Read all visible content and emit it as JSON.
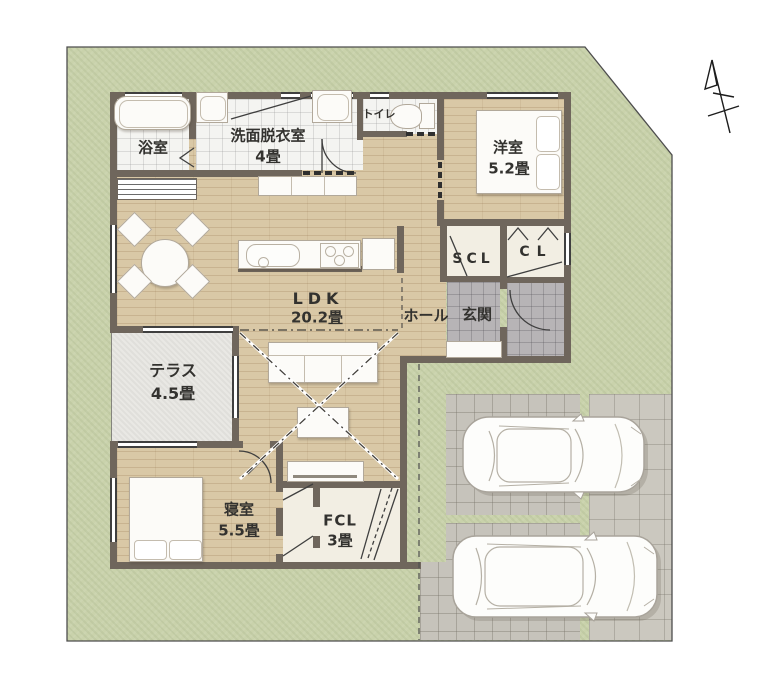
{
  "plan": {
    "rooms": {
      "bathroom": {
        "name": "浴室"
      },
      "washroom": {
        "name": "洗面脱衣室",
        "area": "4畳"
      },
      "toilet": {
        "name": "トイレ"
      },
      "western_room": {
        "name": "洋室",
        "area": "5.2畳"
      },
      "shoe_closet": {
        "name": "SCL"
      },
      "closet": {
        "name": "CL"
      },
      "hall": {
        "name": "ホール"
      },
      "entrance": {
        "name": "玄関"
      },
      "ldk": {
        "name": "LDK",
        "area": "20.2畳"
      },
      "terrace": {
        "name": "テラス",
        "area": "4.5畳"
      },
      "bedroom": {
        "name": "寝室",
        "area": "5.5畳"
      },
      "family_closet": {
        "name": "FCL",
        "area": "3畳"
      }
    },
    "colors": {
      "grass": "#c9d2ab",
      "wood_floor": "#d9c8a6",
      "wall": "#6f665c",
      "white_tile": "#f4f4f1",
      "entry_tile": "#b7b4b6",
      "paving": "#c6c3bb",
      "terrace": "#e9e8e4",
      "closet_floor": "#f2eee3",
      "line": "#3f3f3f"
    }
  }
}
